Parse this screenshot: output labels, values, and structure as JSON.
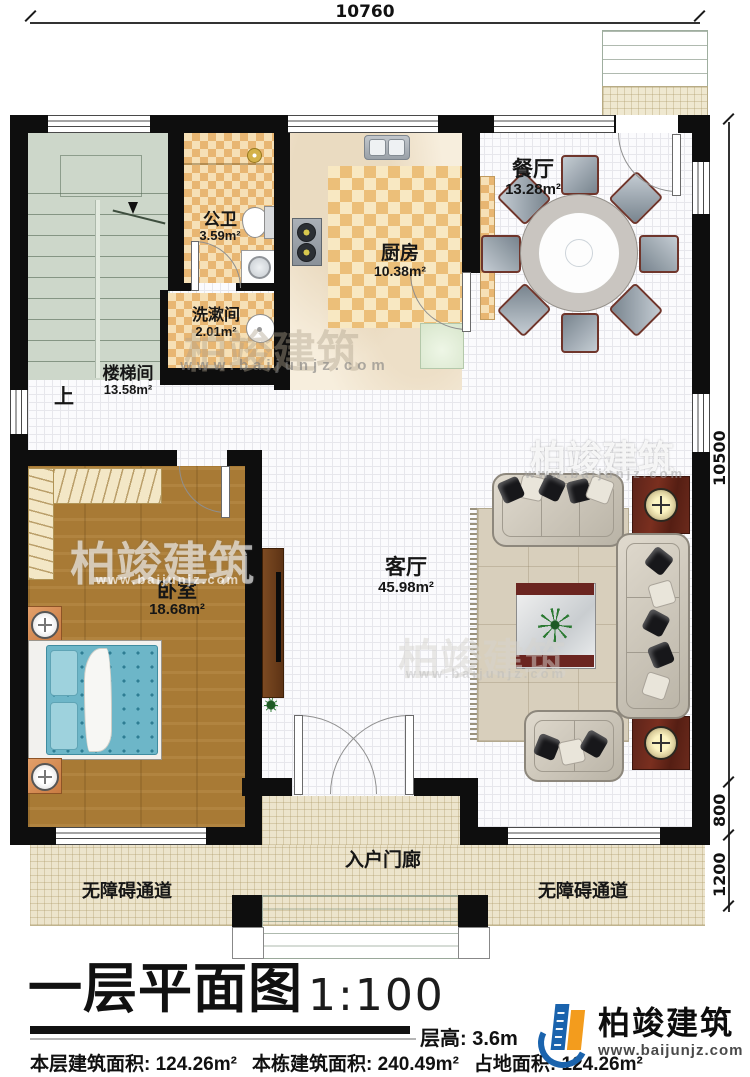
{
  "title": {
    "name": "一层平面图",
    "scale": "1:100"
  },
  "stats": {
    "floor_height": "层高: 3.6m",
    "items": [
      {
        "label": "本层建筑面积:",
        "value": "124.26m²"
      },
      {
        "label": "本栋建筑面积:",
        "value": "240.49m²"
      },
      {
        "label": "占地面积:",
        "value": "124.26m²"
      }
    ]
  },
  "brand": {
    "name": "柏竣建筑",
    "site": "www.baijunjz.com"
  },
  "watermark": {
    "name": "柏竣建筑",
    "site": "www.baijunjz.com"
  },
  "dimensions": {
    "top": "10760",
    "right_main": "10500",
    "right_porch": "800",
    "right_walkway": "1200"
  },
  "labels": {
    "up": "上"
  },
  "rooms": {
    "stairwell": {
      "name": "楼梯间",
      "area": "13.58m²"
    },
    "bathroom": {
      "name": "公卫",
      "area": "3.59m²"
    },
    "washroom": {
      "name": "洗漱间",
      "area": "2.01m²"
    },
    "kitchen": {
      "name": "厨房",
      "area": "10.38m²"
    },
    "dining": {
      "name": "餐厅",
      "area": "13.28m²"
    },
    "bedroom": {
      "name": "卧室",
      "area": "18.68m²"
    },
    "living": {
      "name": "客厅",
      "area": "45.98m²"
    },
    "porch": {
      "name": "入户门廊"
    },
    "walkway": {
      "name": "无障碍通道"
    }
  }
}
